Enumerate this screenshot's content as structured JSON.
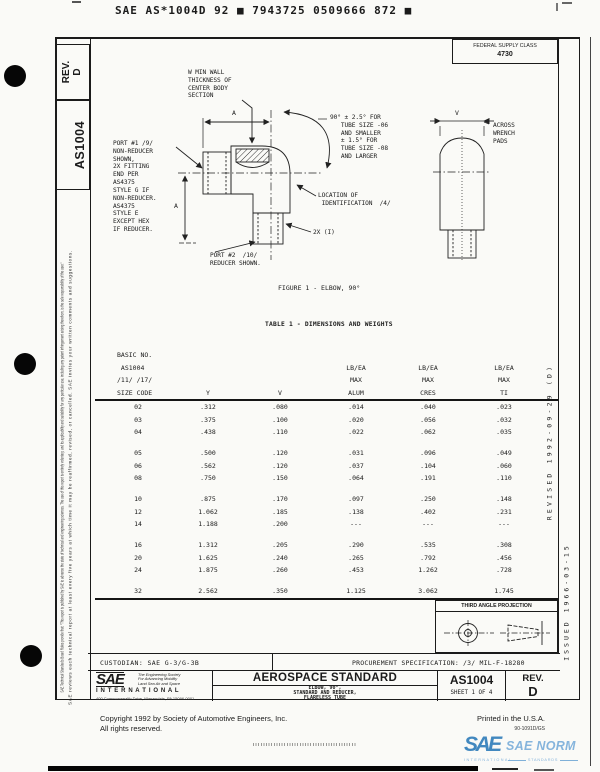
{
  "header": {
    "barcode_line": "SAE AS*1004D 92 ■ 7943725 0509666 872 ■",
    "fsc_label": "FEDERAL SUPPLY CLASS",
    "fsc_value": "4730"
  },
  "sidebar": {
    "rev_box": "REV.\nD",
    "doc_number": "AS1004",
    "disclaimer_line1": "SAE Technical Standards Board Rules provide that: \"This report is published by SAE to advance the state of technical and engineering sciences. The use of this report is entirely voluntary, and its applicability and suitability for any particular use, including any patent infringement arising therefrom, is the sole responsibility of the user.\"",
    "disclaimer_line2": "SAE reviews each technical report at least every five years at which time it may be reaffirmed, revised, or cancelled. SAE invites your written comments and suggestions."
  },
  "right_margin": {
    "revised": "REVISED 1992-09-29 (D)",
    "issued": "ISSUED 1966-03-15"
  },
  "figure": {
    "label_wall": "W MIN WALL\nTHICKNESS OF\nCENTER BODY\nSECTION",
    "label_port1": "PORT #1 /9/\nNON-REDUCER\nSHOWN,\n2X FITTING\nEND PER\nAS4375\nSTYLE G IF\nNON-REDUCER.\nAS4375\nSTYLE E\nEXCEPT HEX\nIF REDUCER.",
    "label_angle": "90° ± 2.5° FOR\n   TUBE SIZE -06\n   AND SMALLER\n   ± 1.5° FOR\n   TUBE SIZE -08\n   AND LARGER",
    "label_across": "ACROSS\nWRENCH\nPADS",
    "label_location": "LOCATION OF\n IDENTIFICATION  /4/",
    "label_2x": "2X (I)",
    "label_port2": "PORT #2  /10/\nREDUCER SHOWN.",
    "dim_a_top": "A",
    "dim_a_left": "A",
    "dim_v": "V",
    "caption": "FIGURE 1 - ELBOW, 90°"
  },
  "table": {
    "title": "TABLE 1 - DIMENSIONS AND WEIGHTS",
    "header_col1": "BASIC NO.\n AS1004\n/11/ /17/\nSIZE CODE",
    "header_cols": [
      "Y",
      "V",
      "LB/EA\nMAX\nALUM",
      "LB/EA\nMAX\nCRES",
      "LB/EA\nMAX\nTI"
    ],
    "row_groups": [
      [
        [
          "02",
          ".312",
          ".080",
          ".014",
          ".040",
          ".023"
        ],
        [
          "03",
          ".375",
          ".100",
          ".020",
          ".056",
          ".032"
        ],
        [
          "04",
          ".438",
          ".110",
          ".022",
          ".062",
          ".035"
        ]
      ],
      [
        [
          "05",
          ".500",
          ".120",
          ".031",
          ".096",
          ".049"
        ],
        [
          "06",
          ".562",
          ".120",
          ".037",
          ".104",
          ".060"
        ],
        [
          "08",
          ".750",
          ".150",
          ".064",
          ".191",
          ".110"
        ]
      ],
      [
        [
          "10",
          ".875",
          ".170",
          ".097",
          ".250",
          ".148"
        ],
        [
          "12",
          "1.062",
          ".185",
          ".138",
          ".402",
          ".231"
        ],
        [
          "14",
          "1.188",
          ".200",
          "---",
          "---",
          "---"
        ]
      ],
      [
        [
          "16",
          "1.312",
          ".205",
          ".290",
          ".535",
          ".308"
        ],
        [
          "20",
          "1.625",
          ".240",
          ".265",
          ".792",
          ".456"
        ],
        [
          "24",
          "1.875",
          ".260",
          ".453",
          "1.262",
          ".728"
        ]
      ],
      [
        [
          "32",
          "2.562",
          ".350",
          "1.125",
          "3.062",
          "1.745"
        ]
      ]
    ]
  },
  "projection": {
    "title": "THIRD ANGLE PROJECTION"
  },
  "footer": {
    "custodian": "CUSTODIAN:  SAE G-3/G-3B",
    "procurement": "PROCUREMENT SPECIFICATION:   /3/  MIL-F-18280",
    "logo_sae": "SAE",
    "logo_tagline": "The Engineering Society\nFor Advancing Mobility\nLand Sea Air and Space",
    "logo_international": "I N T E R N A T I O N A L",
    "logo_address": "400 Commonwealth Drive, Warrendale, PA 15096-0001",
    "block_kind": "AEROSPACE STANDARD",
    "block_title": "ELBOW, 90°,\nSTANDARD AND REDUCER,\nFLARELESS TUBE",
    "block_number": "AS1004",
    "block_sheet": "SHEET 1 OF 4",
    "block_rev_label": "REV.",
    "block_rev": "D",
    "copyright1": "Copyright  1992  by Society of Automotive Engineers, Inc.",
    "copyright2": "All rights reserved.",
    "printed": "Printed in the U.S.A.",
    "print_code": "90-1091D/GS",
    "norm_sae": "SAE",
    "norm_text": "SAE NORM",
    "norm_intl": "INTERNATIONAL",
    "norm_standards": "STANDARDS"
  },
  "colors": {
    "norm_blue_dark": "#4288bf",
    "norm_blue_light": "#85b4dc",
    "paper": "#fafaf7"
  }
}
